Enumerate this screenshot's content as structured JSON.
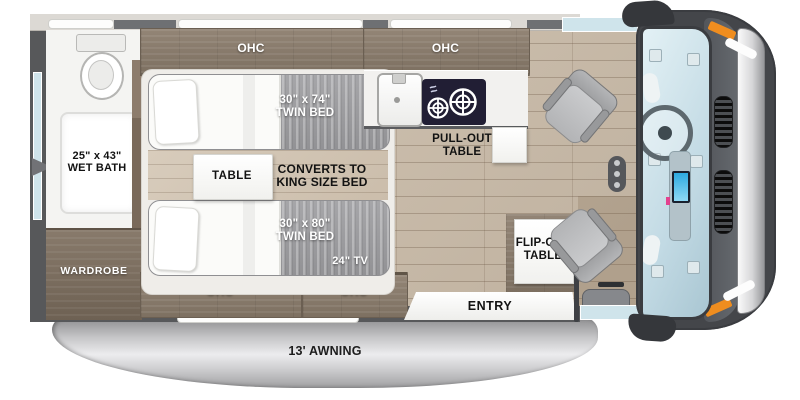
{
  "floorplan": {
    "labels": {
      "ohc": "OHC",
      "wet_bath_size": "25\" x 43\"",
      "wet_bath_name": "WET BATH",
      "wardrobe": "WARDROBE",
      "bed_a_size": "30\" x 74\"",
      "bed_a_name": "TWIN BED",
      "bed_b_size": "30\" x 80\"",
      "bed_b_name": "TWIN BED",
      "table": "TABLE",
      "converts_1": "CONVERTS TO",
      "converts_2": "KING SIZE BED",
      "tv": "24\" TV",
      "pullout_1": "PULL-OUT",
      "pullout_2": "TABLE",
      "flipout_1": "FLIP-OUT",
      "flipout_2": "TABLE",
      "entry": "ENTRY",
      "awning": "13' AWNING"
    },
    "icons": {
      "toilet": "toilet-top-view",
      "sink": "single-bowl-sink",
      "cooktop": "two-burner-cooktop",
      "steering_wheel": "steering-wheel",
      "captain_seat": "swivel-captain-seat",
      "side_mirror": "side-mirror"
    },
    "colors": {
      "wall": "#57585a",
      "cabinet_wood": "#87796a",
      "mattress": "#9b9b9e",
      "floor_wood": "#c8bbaa",
      "cooktop": "#201d33",
      "windshield": "#cfe3ea",
      "marker_orange": "#f08c1e",
      "awning_silver": "#c6c6c8"
    }
  }
}
